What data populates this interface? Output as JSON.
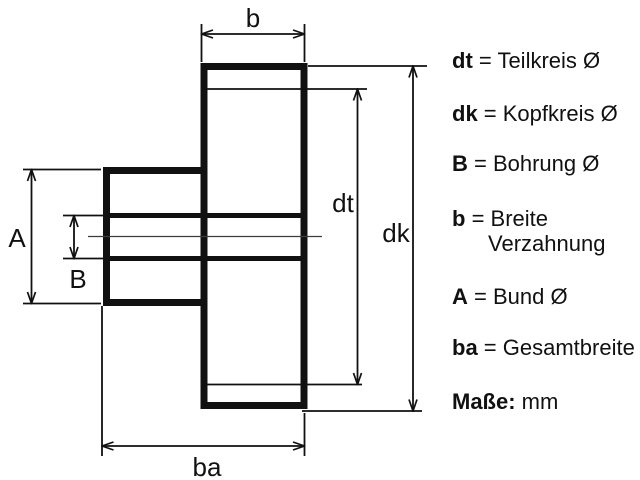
{
  "colors": {
    "ink": "#111111",
    "background": "#ffffff"
  },
  "drawing": {
    "labels": {
      "b": "b",
      "dt": "dt",
      "dk": "dk",
      "A": "A",
      "B": "B",
      "ba": "ba"
    }
  },
  "legend": {
    "items": [
      {
        "key": "dt",
        "rest": " = Teilkreis Ø"
      },
      {
        "key": "dk",
        "rest": " = Kopfkreis Ø"
      },
      {
        "key": "B",
        "rest": " = Bohrung Ø"
      },
      {
        "key": "b",
        "rest": " = Breite\nVerzahnung"
      },
      {
        "key": "A",
        "rest": " = Bund Ø"
      },
      {
        "key": "ba",
        "rest": " = Gesamtbreite"
      },
      {
        "key": "Maße:",
        "rest": " mm"
      }
    ]
  }
}
